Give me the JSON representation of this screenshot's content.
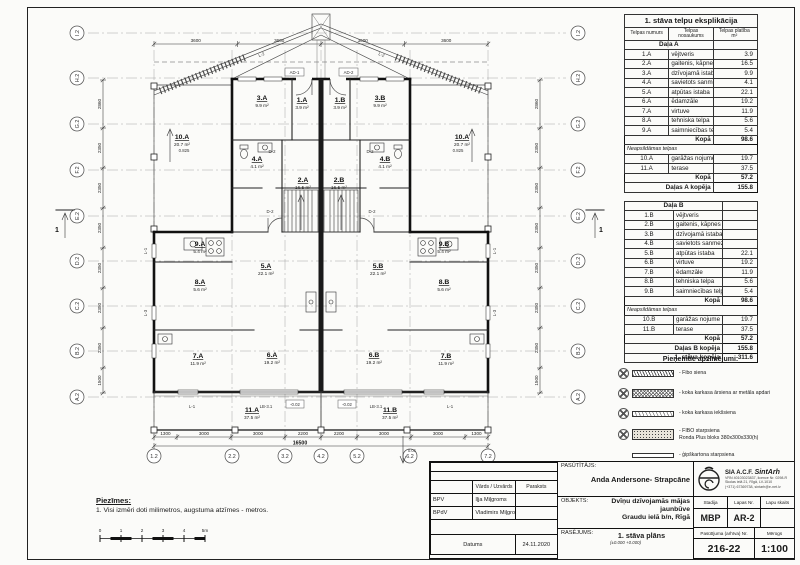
{
  "plan": {
    "grid": {
      "rows": [
        "I.2",
        "H.2",
        "G.2",
        "F.2",
        "E.2",
        "D.2",
        "C.2",
        "B.2",
        "A.2"
      ],
      "cols": [
        "1.2",
        "2.2",
        "3.2",
        "4.2",
        "5.2",
        "6.2",
        "7.2"
      ]
    },
    "dims": {
      "bottom": [
        "1300",
        "3000",
        "3000",
        "2200",
        "2200",
        "3000",
        "3000",
        "1300"
      ],
      "bottom_total": "16500",
      "top": [
        "3600",
        "3600",
        "3600",
        "3600"
      ],
      "left": [
        "2860",
        "2350",
        "2350",
        "2350",
        "2350",
        "2350",
        "2350",
        "1500"
      ],
      "right": [
        "2860",
        "2350",
        "2350",
        "2350",
        "2350",
        "2350",
        "2350",
        "1500"
      ]
    },
    "rooms": [
      {
        "id": "1.A",
        "area": "3.9 m²"
      },
      {
        "id": "3.A",
        "area": "9.9 m²"
      },
      {
        "id": "4.A",
        "area": "4.1 m²"
      },
      {
        "id": "2.A",
        "area": "16.5 m²"
      },
      {
        "id": "10.A",
        "area": "20.7 m²"
      },
      {
        "id": "9.A",
        "area": "5.4 m²"
      },
      {
        "id": "8.A",
        "area": "5.6 m²"
      },
      {
        "id": "5.A",
        "area": "22.1 m²"
      },
      {
        "id": "7.A",
        "area": "11.9 m²"
      },
      {
        "id": "6.A",
        "area": "19.2 m²"
      },
      {
        "id": "11.A",
        "area": "37.5 m²"
      },
      {
        "id": "1.B",
        "area": "3.9 m²"
      },
      {
        "id": "3.B",
        "area": "9.9 m²"
      },
      {
        "id": "4.B",
        "area": "4.1 m²"
      },
      {
        "id": "2.B",
        "area": "16.5 m²"
      },
      {
        "id": "10.A",
        "area": "20.7 m²"
      },
      {
        "id": "9.B",
        "area": "5.4 m²"
      },
      {
        "id": "8.B",
        "area": "5.6 m²"
      },
      {
        "id": "5.B",
        "area": "22.1 m²"
      },
      {
        "id": "7.B",
        "area": "11.9 m²"
      },
      {
        "id": "6.B",
        "area": "19.2 m²"
      },
      {
        "id": "11.B",
        "area": "37.5 m²"
      }
    ],
    "tags": {
      "section": "1",
      "elev": "0.825",
      "slope": "0.01",
      "terr_elev": "-0.02",
      "ad1": "AD-1",
      "ad2": "AD-2",
      "l1": "L-1",
      "l2": "L-2",
      "l3": "L-3",
      "lb31": "LB-3.1",
      "d2": "D-2"
    }
  },
  "exp_table_a": {
    "title": "1. stāva telpu eksplikācija",
    "col_num": "Telpas numurs",
    "col_name": "Telpas nosaukums",
    "col_area": "Telpas platība m²",
    "section": "Daļa A",
    "rows": [
      [
        "1.A",
        "vējtveris",
        "3.9"
      ],
      [
        "2.A",
        "gaitenis, kāpnes",
        "16.5"
      ],
      [
        "3.A",
        "dzīvojamā istaba",
        "9.9"
      ],
      [
        "4.A",
        "savietots sanmezgls",
        "4.1"
      ],
      [
        "5.A",
        "atpūtas istaba",
        "22.1"
      ],
      [
        "6.A",
        "ēdamzāle",
        "19.2"
      ],
      [
        "7.A",
        "virtuve",
        "11.9"
      ],
      [
        "8.A",
        "tehniska telpa",
        "5.6"
      ],
      [
        "9.A",
        "saimniecības telpa",
        "5.4"
      ]
    ],
    "kopa_label": "Kopā",
    "kopa_value": "98.6",
    "unheated_label": "Neapsildāmas telpas",
    "unheated_rows": [
      [
        "10.A",
        "garāžas nojume",
        "19.7"
      ],
      [
        "11.A",
        "terase",
        "37.5"
      ]
    ],
    "kopa2_value": "57.2",
    "total_label": "Daļas A kopēja",
    "total_value": "155.8"
  },
  "exp_table_b": {
    "section": "Daļa B",
    "rows": [
      [
        "1.B",
        "vējtveris",
        ""
      ],
      [
        "2.B",
        "gaitenis, kāpnes",
        ""
      ],
      [
        "3.B",
        "dzīvojamā istaba",
        ""
      ],
      [
        "4.B",
        "savietots sanmezgls",
        ""
      ],
      [
        "5.B",
        "atpūtas istaba",
        "22.1"
      ],
      [
        "6.B",
        "virtuve",
        "19.2"
      ],
      [
        "7.B",
        "ēdamzāle",
        "11.9"
      ],
      [
        "8.B",
        "tehniska telpa",
        "5.6"
      ],
      [
        "9.B",
        "saimniecības telpa",
        "5.4"
      ]
    ],
    "kopa_label": "Kopā",
    "kopa_value": "98.6",
    "unheated_label": "Neapsildāmas telpas",
    "unheated_rows": [
      [
        "10.B",
        "garāžas nojume",
        "19.7"
      ],
      [
        "11.B",
        "terase",
        "37.5"
      ]
    ],
    "kopa2_value": "57.2",
    "total_label": "Daļas B kopēja",
    "total_value": "155.8",
    "grand_label": "1. stāva kopēja",
    "grand_value": "311.6"
  },
  "legend": {
    "title": "Pieņemtie apzīmējumi:",
    "items": [
      {
        "text": "- Fibo siena",
        "text2": ""
      },
      {
        "text": "- koka karkasa ārsiena ar metāla apdari",
        "text2": ""
      },
      {
        "text": "- koka karkasa iekšsiena",
        "text2": ""
      },
      {
        "text": "- FIBO starpsiena",
        "text2": "Ronda Plus bloks 380x300x330(h)"
      },
      {
        "text": "- ģipškartona starpsiena",
        "text2": ""
      }
    ]
  },
  "notes": {
    "title": "Piezīmes:",
    "item": "1.  Visi izmēri doti milimetros, augstuma atzīmes - metros."
  },
  "scalebar": {
    "labels": [
      "0",
      "1",
      "2",
      "3",
      "4",
      "5m"
    ]
  },
  "titleblock": {
    "pasutitajs_label": "PASŪTĪTĀJS:",
    "pasutitajs": "Anda Andersone- Strapcāne",
    "objekts_label": "OBJEKTS:",
    "objekts_line1": "Dvīņu dzīvojamās mājas jaunbūve",
    "objekts_line2": "Graudu ielā b/n, Rīgā",
    "rasejums_label": "RASĒJUMS:",
    "rasejums": "1. stāva plāns",
    "rasejums_note": "(±0.000 +0.000)",
    "stadija_label": "Stadija",
    "stadija": "MBP",
    "lapas_label": "Lapas Nr.",
    "lapas": "AR-2",
    "lapu_label": "Lapu skaits",
    "lapu": "",
    "pasutijuma_label": "Pasūtījuma (arhīva) Nr.",
    "pasutijuma": "216-22",
    "merogs_label": "Mērogs",
    "merogs": "1:100",
    "firm": {
      "prefix": "SIA A.C.F.",
      "name": "SintArh",
      "line1": "VRN 40103023837, licence Nr. 0298-R",
      "line2": "Skolas ielā 21, Rīgā, LV-1010",
      "line3": "(+371) 67369738, sintarh@e-net.lv"
    },
    "personnel": {
      "h_name": "Vārds / Uzvārds",
      "h_sign": "Paraksts",
      "rows": [
        [
          "BPV",
          "Iļja Miļgroms",
          ""
        ],
        [
          "BPdV",
          "Vladimirs Miļgroms",
          ""
        ]
      ],
      "datums_label": "Datums",
      "datums": "24.11.2020"
    }
  }
}
